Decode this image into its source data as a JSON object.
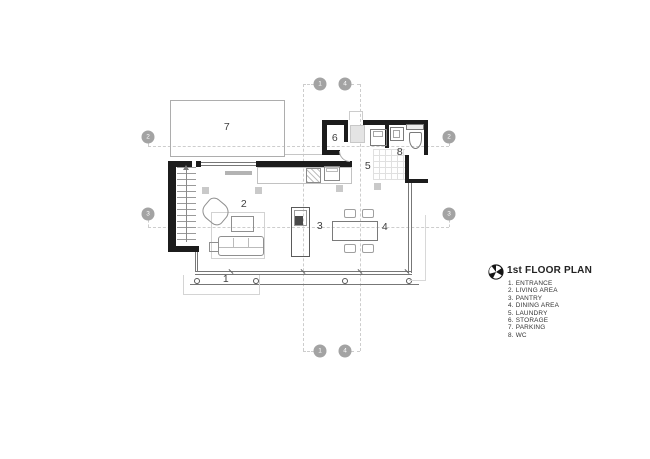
{
  "legend": {
    "title": "1st FLOOR PLAN",
    "logo_icon": "pinwheel-logo",
    "items": [
      {
        "num": "1",
        "label": "ENTRANCE"
      },
      {
        "num": "2",
        "label": "LIVING AREA"
      },
      {
        "num": "3",
        "label": "PANTRY"
      },
      {
        "num": "4",
        "label": "DINING AREA"
      },
      {
        "num": "5",
        "label": "LAUNDRY"
      },
      {
        "num": "6",
        "label": "STORAGE"
      },
      {
        "num": "7",
        "label": "PARKING"
      },
      {
        "num": "8",
        "label": "WC"
      }
    ]
  },
  "plan": {
    "room_labels": [
      {
        "num": "1",
        "x": 226,
        "y": 279
      },
      {
        "num": "2",
        "x": 244,
        "y": 204
      },
      {
        "num": "3",
        "x": 320,
        "y": 226
      },
      {
        "num": "4",
        "x": 385,
        "y": 227
      },
      {
        "num": "5",
        "x": 368,
        "y": 166
      },
      {
        "num": "6",
        "x": 335,
        "y": 138
      },
      {
        "num": "7",
        "x": 227,
        "y": 127
      },
      {
        "num": "8",
        "x": 400,
        "y": 152
      }
    ],
    "grid_bubbles": [
      {
        "num": "1",
        "x": 320,
        "y": 84
      },
      {
        "num": "4",
        "x": 345,
        "y": 84
      },
      {
        "num": "2",
        "x": 148,
        "y": 137
      },
      {
        "num": "2",
        "x": 449,
        "y": 137
      },
      {
        "num": "3",
        "x": 148,
        "y": 214
      },
      {
        "num": "3",
        "x": 449,
        "y": 214
      },
      {
        "num": "1",
        "x": 320,
        "y": 351
      },
      {
        "num": "4",
        "x": 345,
        "y": 351
      }
    ]
  },
  "colors": {
    "background": "#ffffff",
    "wall": "#1c1c1c",
    "thin_line": "#777777",
    "light_line": "#c2c2c2",
    "grid_dash": "#cdcdcd",
    "grid_bubble": "#a3a3a3",
    "room_label_text": "#3f3f3f",
    "legend_text": "#333333"
  }
}
